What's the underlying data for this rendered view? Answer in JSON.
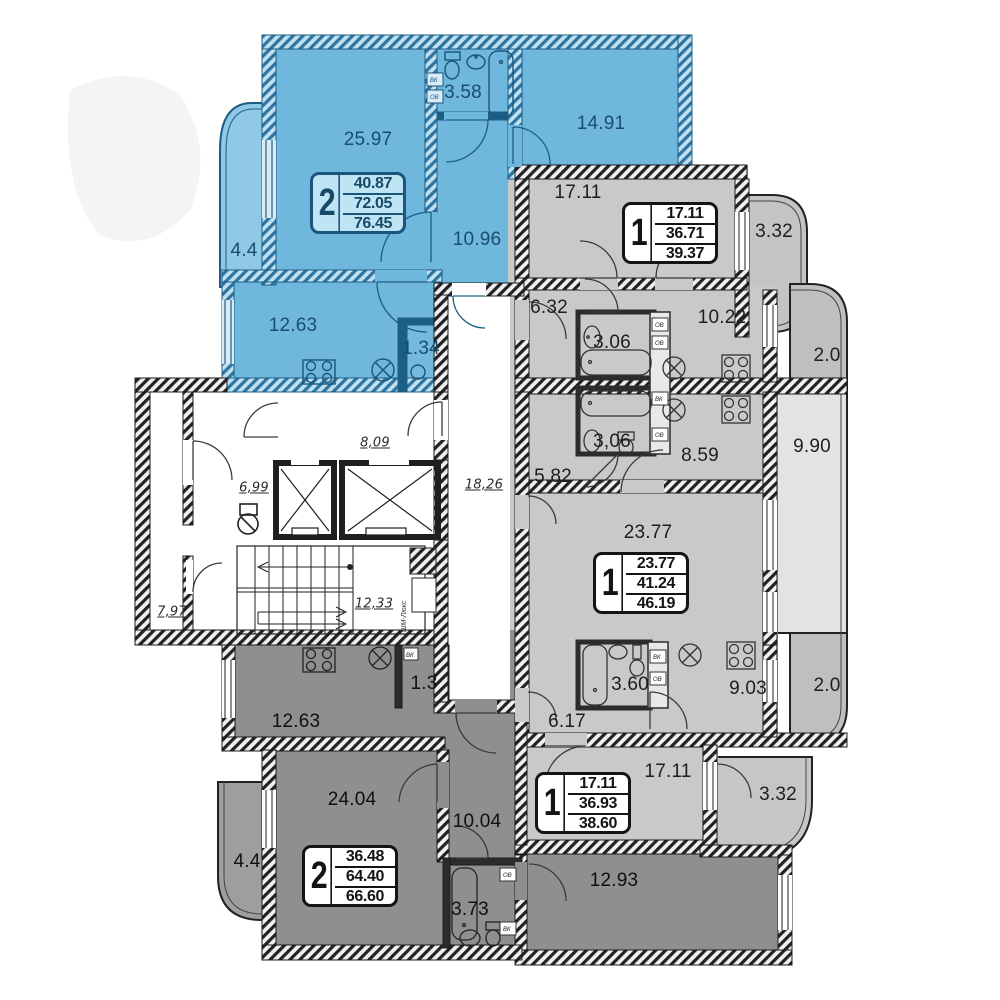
{
  "plan_title": "residential-floor-plan",
  "colors": {
    "blue_room": "#6fb7dd",
    "blue_balcony": "#8fc9e6",
    "blue_wall": "#1c5e86",
    "gray_room": "#c9c9c9",
    "gray_balcony": "#bfbfbf",
    "loggia": "#e3e3e3",
    "dark_room": "#8f8f8f",
    "wall": "#1b1b1b",
    "card_blue_bg": "#bfe4f4"
  },
  "apartments": [
    {
      "key": "top-left-2-room",
      "type_label": "2",
      "stats": [
        "40.87",
        "72.05",
        "76.45"
      ],
      "rooms": [
        {
          "name": "living",
          "label": "25.97"
        },
        {
          "name": "bathroom",
          "label": "3.58"
        },
        {
          "name": "bedroom",
          "label": "14.91"
        },
        {
          "name": "hall",
          "label": "10.96"
        },
        {
          "name": "balcony",
          "label": "4.4"
        },
        {
          "name": "kitchen",
          "label": "12.63"
        },
        {
          "name": "storage",
          "label": "1.34"
        }
      ]
    },
    {
      "key": "top-right-1-room",
      "type_label": "1",
      "stats": [
        "17.11",
        "36.71",
        "39.37"
      ],
      "rooms": [
        {
          "name": "living",
          "label": "17.11"
        },
        {
          "name": "balcony",
          "label": "3.32"
        },
        {
          "name": "hall",
          "label": "6.32"
        },
        {
          "name": "bathroom",
          "label": "3.06"
        },
        {
          "name": "kitchen",
          "label": "10.22"
        },
        {
          "name": "balcony2",
          "label": "2.0"
        }
      ]
    },
    {
      "key": "middle-right-1-room",
      "type_label": "1",
      "stats": [
        "23.77",
        "41.24",
        "46.19"
      ],
      "rooms": [
        {
          "name": "bathroom",
          "label": "3,06"
        },
        {
          "name": "hall",
          "label": "5,82"
        },
        {
          "name": "kitchen",
          "label": "8.59"
        },
        {
          "name": "loggia",
          "label": "9.90"
        },
        {
          "name": "living",
          "label": "23.77"
        }
      ]
    },
    {
      "key": "bottom-right-1-room",
      "type_label": "1",
      "stats": [
        "17.11",
        "36.93",
        "38.60"
      ],
      "rooms": [
        {
          "name": "bathroom",
          "label": "3.60"
        },
        {
          "name": "hall",
          "label": "6.17"
        },
        {
          "name": "kitchen",
          "label": "9.03"
        },
        {
          "name": "balcony",
          "label": "2.0"
        },
        {
          "name": "living",
          "label": "17.11"
        },
        {
          "name": "balcony2",
          "label": "3.32"
        }
      ]
    },
    {
      "key": "bottom-left-2-room",
      "type_label": "2",
      "stats": [
        "36.48",
        "64.40",
        "66.60"
      ],
      "rooms": [
        {
          "name": "kitchen",
          "label": "12.63"
        },
        {
          "name": "storage",
          "label": "1.3"
        },
        {
          "name": "living",
          "label": "24.04"
        },
        {
          "name": "hall",
          "label": "10.04"
        },
        {
          "name": "balcony",
          "label": "4.4"
        },
        {
          "name": "bathroom",
          "label": "3.73"
        },
        {
          "name": "bedroom",
          "label": "12.93"
        }
      ]
    }
  ],
  "core": {
    "labels": [
      {
        "name": "lobby",
        "label": "8,09"
      },
      {
        "name": "vestibule",
        "label": "6,99"
      },
      {
        "name": "corridor",
        "label": "18,26"
      },
      {
        "name": "left-room",
        "label": "7,97"
      },
      {
        "name": "stairwell",
        "label": "12,33"
      }
    ],
    "chute_label": "ШМ-Люкс"
  },
  "shafts": {
    "vk": "ВК",
    "ov": "ОВ"
  }
}
